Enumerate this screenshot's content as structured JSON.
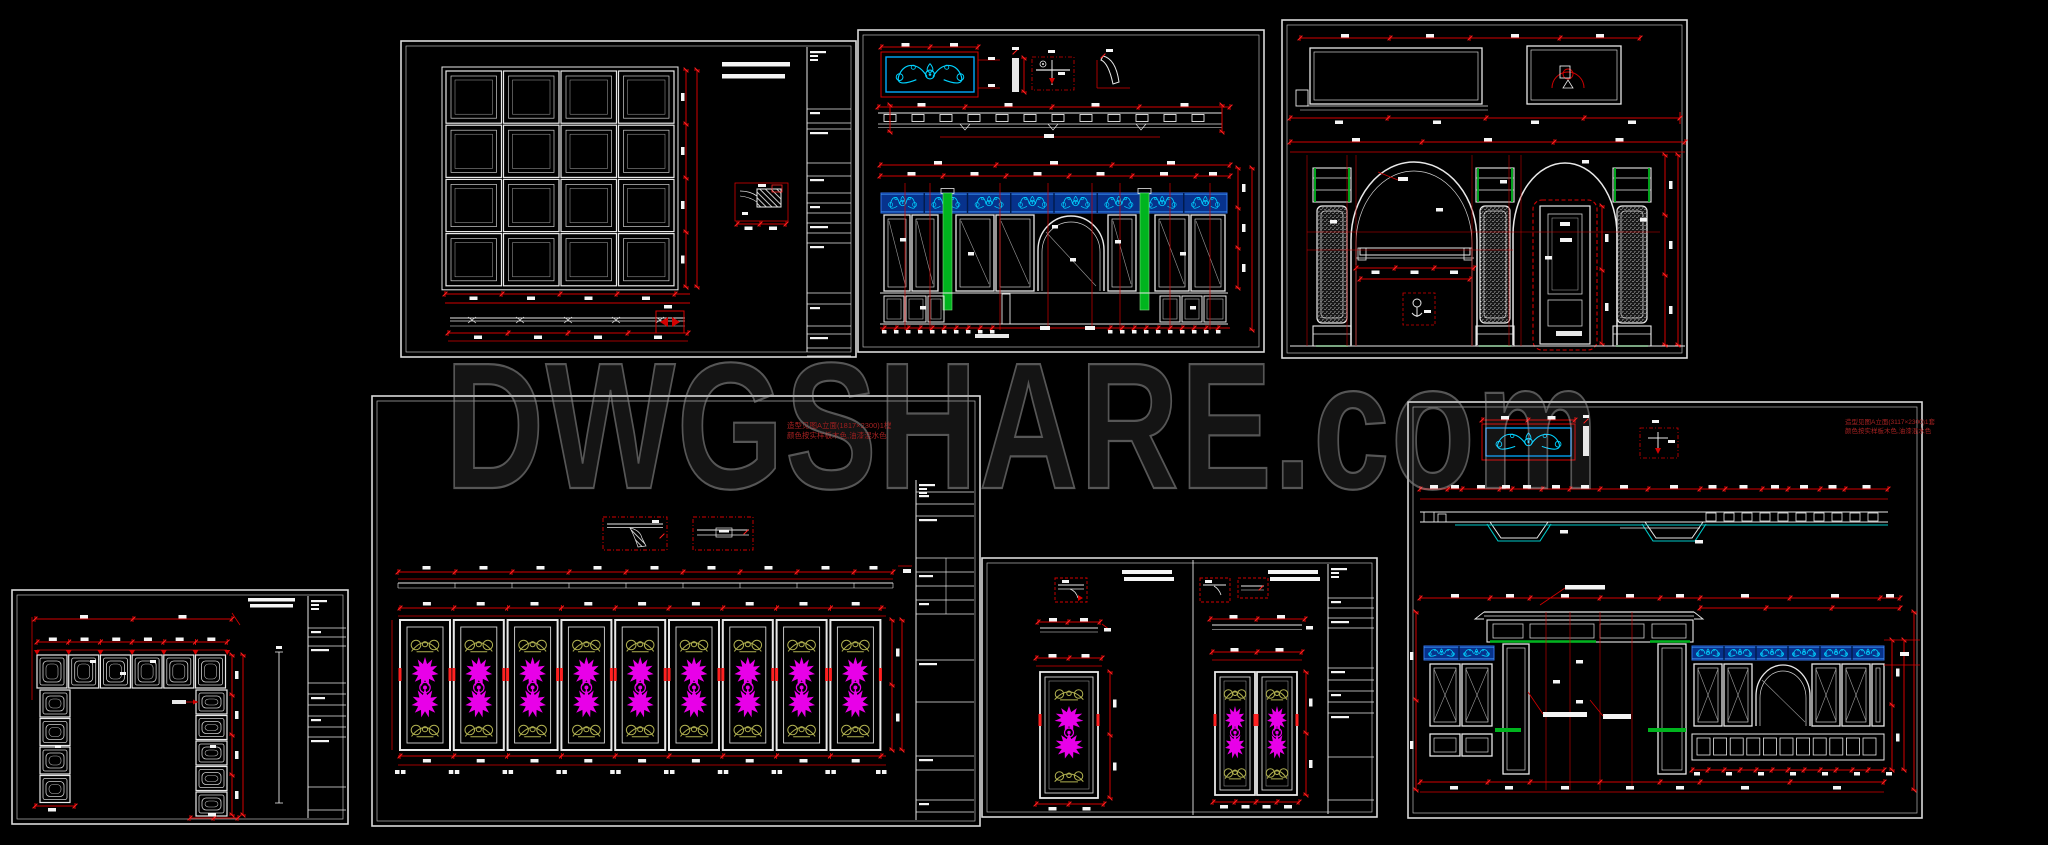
{
  "watermark": {
    "text": "DWGSHARE.com",
    "stroke_color": "#565656",
    "fill_color": "#161616"
  },
  "palette": {
    "background": "#000000",
    "sheet_border": "#d9d9d9",
    "line_white": "#e8e8e8",
    "blob_white": "#f5f5f5",
    "dim_red": "#d40000",
    "bright_red": "#ff2222",
    "dark_red": "#8b0000",
    "green": "#00b41e",
    "frieze_blue": "#07328c",
    "frieze_edge": "#2f72e8",
    "cyan_ornament": "#00d2ff",
    "cyan_box": "#00aaff",
    "teal_line": "#00c8c8",
    "magenta": "#e male800e8",
    "magenta_fix": "#e800e8",
    "olive": "#b0b050",
    "gray_line": "#9a9a9a"
  },
  "annotations": {
    "mid_sheet": {
      "line1": "造型见图A立面(1817×2300)1樘",
      "line2": "颜色按实样板木色,油漆混水色"
    },
    "right_sheet": {
      "line1": "造型见图A立面(3117×2300)1套",
      "line2": "颜色按实样板木色,油漆混水色"
    }
  },
  "sheets": [
    {
      "id": "a",
      "name": "coffered-grid-panel-elevation",
      "grid_rows": 4,
      "grid_cols": 4
    },
    {
      "id": "b",
      "name": "carved-cabinet-elevation",
      "frieze_segments": 8
    },
    {
      "id": "c",
      "name": "double-arch-pilaster-elevation",
      "pilasters": 3,
      "arches": 2
    },
    {
      "id": "d",
      "name": "nine-panel-carved-wall-elevation",
      "panels": 9
    },
    {
      "id": "e",
      "name": "coffered-door-surround",
      "top_blocks": 6,
      "left_blocks": 4,
      "right_blocks": 5
    },
    {
      "id": "f",
      "name": "carved-door-panels",
      "left_doors": 1,
      "right_doors": 2
    },
    {
      "id": "g",
      "name": "carved-cabinet-elevation-b",
      "frieze_segments_left": 2,
      "frieze_segments_right": 6
    }
  ]
}
